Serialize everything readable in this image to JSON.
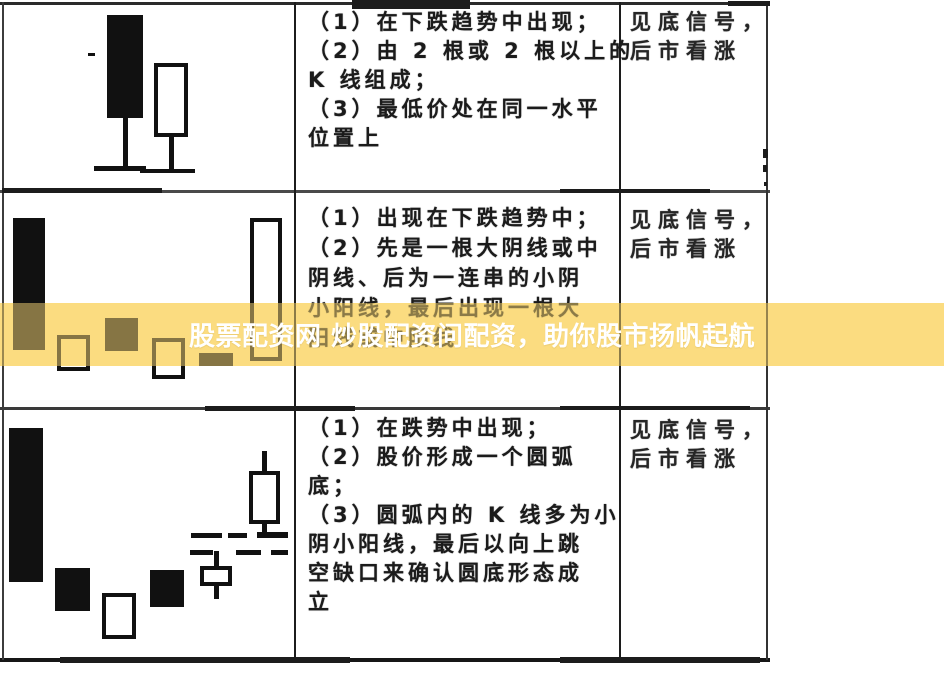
{
  "banner": {
    "text": "股票配资网 炒股配资问配资，助你股市扬帆起航",
    "background_color": "#FBDC80",
    "text_color": "#FFFFFF"
  },
  "table": {
    "rows": [
      {
        "description_lines": [
          "（1）在下跌趋势中出现；",
          "（2）由 2 根或 2 根以上的",
          "K 线组成；",
          "（3）最低价处在同一水平",
          "位置上"
        ],
        "signal_lines": [
          "见底信号，",
          "后市看涨"
        ]
      },
      {
        "description_lines": [
          "（1）出现在下跌趋势中；",
          "（2）先是一根大阴线或中",
          "阴线、后为一连串的小阴",
          "小阳线，最后出现一根大",
          "阳线或中阳线"
        ],
        "signal_lines": [
          "见底信号，",
          "后市看涨"
        ]
      },
      {
        "description_lines": [
          "（1）在跌势中出现；",
          "（2）股价形成一个圆弧",
          "底；",
          "（3）圆弧内的 K 线多为小",
          "阴小阳线，最后以向上跳",
          "空缺口来确认圆底形态成",
          "立"
        ],
        "signal_lines": [
          "见底信号，",
          "后市看涨"
        ]
      }
    ]
  },
  "patterns": [
    {
      "candles": [
        {
          "type": "filled",
          "x": 107,
          "y": 15,
          "w": 36,
          "h": 103,
          "wick_bottom": [
            118,
            168
          ]
        },
        {
          "type": "hollow",
          "x": 154,
          "y": 63,
          "w": 34,
          "h": 74,
          "wick_bottom": [
            137,
            169
          ]
        }
      ],
      "base_lines": [
        {
          "x": 94,
          "y": 166,
          "w": 52,
          "h": 5
        },
        {
          "x": 140,
          "y": 169,
          "w": 55,
          "h": 4
        }
      ],
      "dashes": [
        {
          "x": 88,
          "y": 53,
          "w": 7,
          "h": 3
        }
      ]
    },
    {
      "candles": [
        {
          "type": "filled",
          "x": 13,
          "y": 218,
          "w": 32,
          "h": 132
        },
        {
          "type": "hollow",
          "x": 57,
          "y": 335,
          "w": 33,
          "h": 36
        },
        {
          "type": "filled",
          "x": 105,
          "y": 318,
          "w": 33,
          "h": 33
        },
        {
          "type": "hollow",
          "x": 152,
          "y": 338,
          "w": 33,
          "h": 41
        },
        {
          "type": "filled",
          "x": 199,
          "y": 353,
          "w": 34,
          "h": 13
        },
        {
          "type": "hollow",
          "x": 250,
          "y": 218,
          "w": 32,
          "h": 143
        }
      ],
      "base_lines": [],
      "dashes": []
    },
    {
      "candles": [
        {
          "type": "filled",
          "x": 9,
          "y": 428,
          "w": 34,
          "h": 154
        },
        {
          "type": "filled",
          "x": 55,
          "y": 568,
          "w": 35,
          "h": 43
        },
        {
          "type": "hollow",
          "x": 102,
          "y": 593,
          "w": 34,
          "h": 46
        },
        {
          "type": "filled",
          "x": 150,
          "y": 570,
          "w": 34,
          "h": 37
        },
        {
          "type": "hollow",
          "x": 200,
          "y": 566,
          "w": 32,
          "h": 20,
          "wick_top": [
            551,
            566
          ],
          "wick_bottom": [
            586,
            599
          ]
        },
        {
          "type": "hollow",
          "x": 249,
          "y": 471,
          "w": 31,
          "h": 53,
          "wick_top": [
            451,
            471
          ],
          "wick_bottom": [
            524,
            536
          ]
        }
      ],
      "base_lines": [],
      "dashes": [
        {
          "x": 191,
          "y": 533,
          "w": 31,
          "h": 5
        },
        {
          "x": 228,
          "y": 533,
          "w": 19,
          "h": 5
        },
        {
          "x": 257,
          "y": 532,
          "w": 31,
          "h": 6
        },
        {
          "x": 190,
          "y": 550,
          "w": 23,
          "h": 5
        },
        {
          "x": 236,
          "y": 550,
          "w": 25,
          "h": 5
        },
        {
          "x": 271,
          "y": 550,
          "w": 17,
          "h": 5
        }
      ]
    }
  ],
  "scan_marks": [
    {
      "x": 352,
      "y": 0,
      "w": 118,
      "h": 9
    },
    {
      "x": 728,
      "y": 1,
      "w": 42,
      "h": 5
    },
    {
      "x": 763,
      "y": 149,
      "w": 5,
      "h": 9
    },
    {
      "x": 763,
      "y": 165,
      "w": 4,
      "h": 7
    },
    {
      "x": 764,
      "y": 182,
      "w": 3,
      "h": 4
    },
    {
      "x": 2,
      "y": 188,
      "w": 160,
      "h": 5
    },
    {
      "x": 560,
      "y": 189,
      "w": 150,
      "h": 4
    },
    {
      "x": 205,
      "y": 406,
      "w": 150,
      "h": 5
    },
    {
      "x": 560,
      "y": 406,
      "w": 190,
      "h": 4
    },
    {
      "x": 60,
      "y": 657,
      "w": 290,
      "h": 6
    },
    {
      "x": 560,
      "y": 657,
      "w": 200,
      "h": 6
    }
  ],
  "colors": {
    "ink": "#1B1B1B",
    "paper": "#FFFFFF"
  }
}
